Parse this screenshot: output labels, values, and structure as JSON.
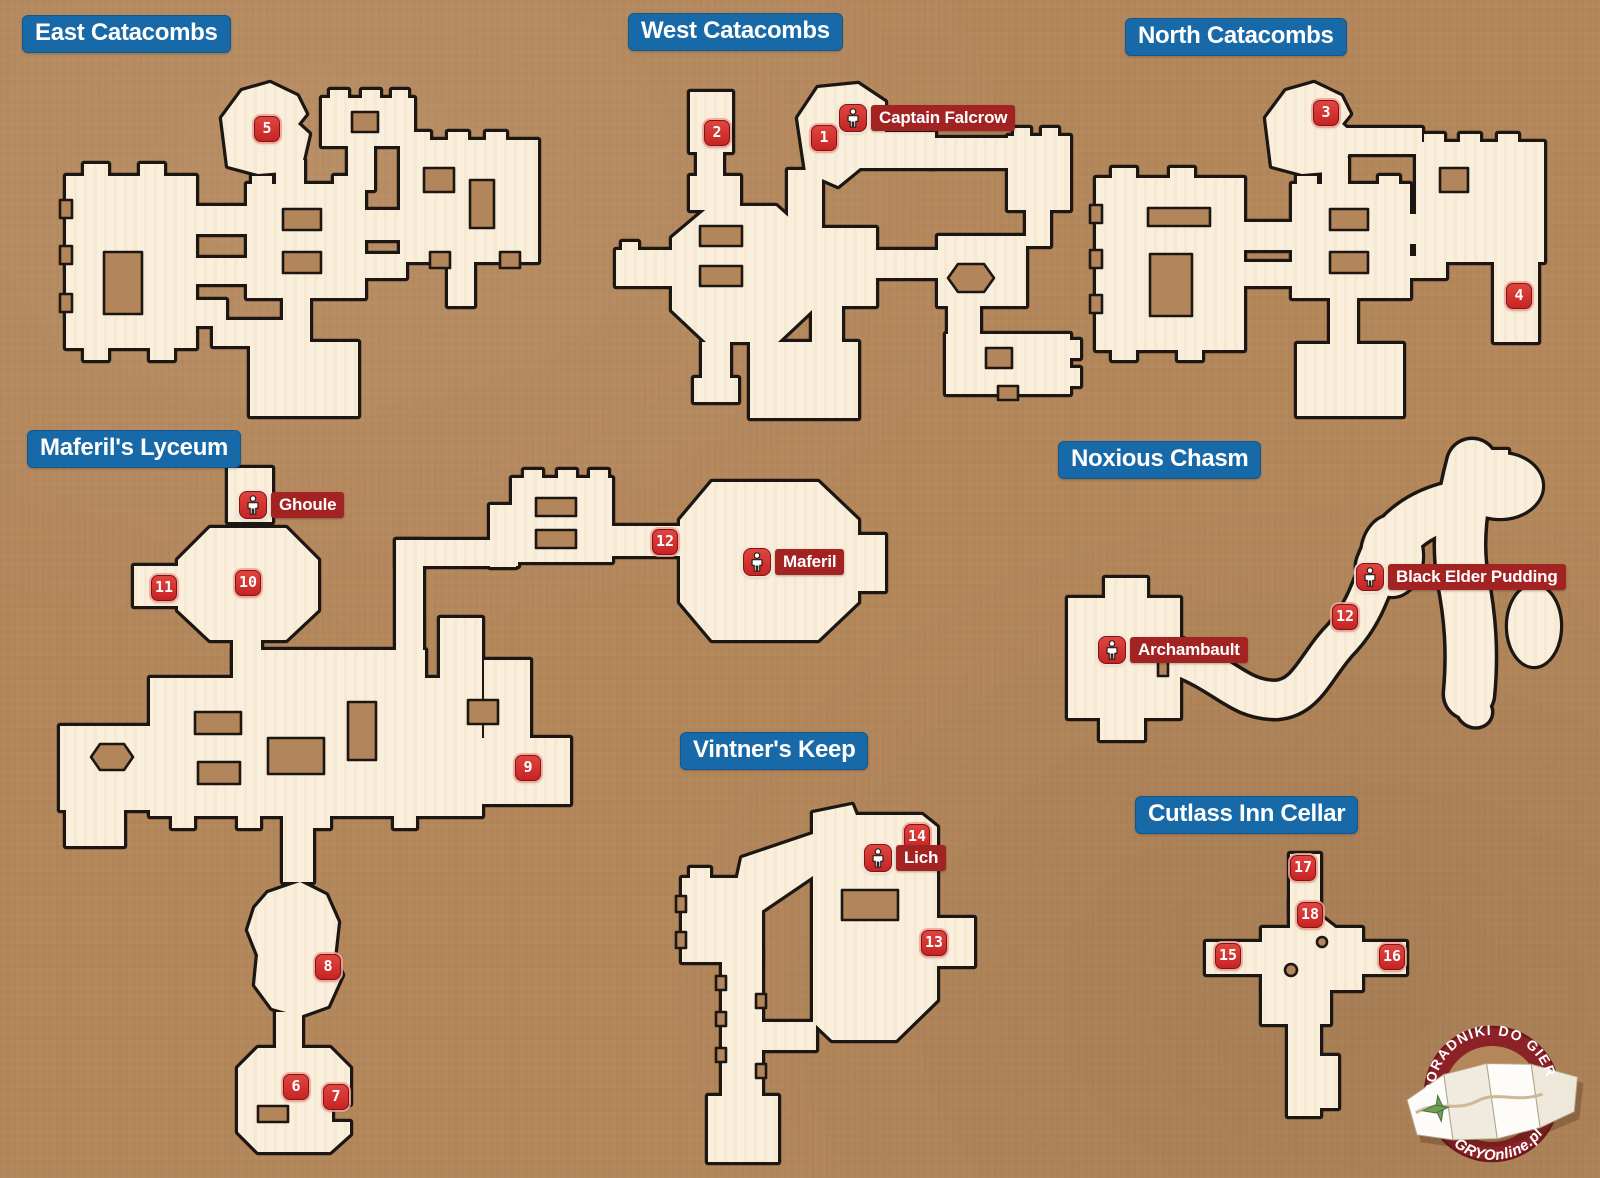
{
  "page": {
    "width": 1600,
    "height": 1178
  },
  "colors": {
    "background": "#b4875b",
    "map_fill": "#f9efdc",
    "outline": "#1d1713",
    "title_bg": "#1769a8",
    "marker_red": "#d03030",
    "npc_label_bg": "#a32323",
    "logo_red": "#8c2127"
  },
  "sections": [
    {
      "id": "east-catacombs",
      "title": "East Catacombs",
      "title_pos": {
        "x": 22,
        "y": 15
      }
    },
    {
      "id": "west-catacombs",
      "title": "West Catacombs",
      "title_pos": {
        "x": 628,
        "y": 13
      }
    },
    {
      "id": "north-catacombs",
      "title": "North Catacombs",
      "title_pos": {
        "x": 1125,
        "y": 18
      }
    },
    {
      "id": "maferils-lyceum",
      "title": "Maferil's Lyceum",
      "title_pos": {
        "x": 27,
        "y": 430
      }
    },
    {
      "id": "noxious-chasm",
      "title": "Noxious Chasm",
      "title_pos": {
        "x": 1058,
        "y": 441
      }
    },
    {
      "id": "vintners-keep",
      "title": "Vintner's Keep",
      "title_pos": {
        "x": 680,
        "y": 732
      }
    },
    {
      "id": "cutlass-inn-cellar",
      "title": "Cutlass Inn Cellar",
      "title_pos": {
        "x": 1135,
        "y": 796
      }
    }
  ],
  "markers": [
    {
      "section": "east-catacombs",
      "number": "5",
      "x": 267,
      "y": 129
    },
    {
      "section": "west-catacombs",
      "number": "2",
      "x": 717,
      "y": 133
    },
    {
      "section": "west-catacombs",
      "number": "1",
      "x": 824,
      "y": 138
    },
    {
      "section": "north-catacombs",
      "number": "3",
      "x": 1326,
      "y": 113
    },
    {
      "section": "north-catacombs",
      "number": "4",
      "x": 1519,
      "y": 296
    },
    {
      "section": "maferils-lyceum",
      "number": "11",
      "x": 164,
      "y": 588
    },
    {
      "section": "maferils-lyceum",
      "number": "10",
      "x": 248,
      "y": 583
    },
    {
      "section": "maferils-lyceum",
      "number": "12",
      "x": 665,
      "y": 542
    },
    {
      "section": "maferils-lyceum",
      "number": "9",
      "x": 528,
      "y": 768
    },
    {
      "section": "maferils-lyceum",
      "number": "8",
      "x": 328,
      "y": 967
    },
    {
      "section": "maferils-lyceum",
      "number": "6",
      "x": 296,
      "y": 1087
    },
    {
      "section": "maferils-lyceum",
      "number": "7",
      "x": 336,
      "y": 1097
    },
    {
      "section": "noxious-chasm",
      "number": "12",
      "x": 1345,
      "y": 617
    },
    {
      "section": "vintners-keep",
      "number": "14",
      "x": 917,
      "y": 837
    },
    {
      "section": "vintners-keep",
      "number": "13",
      "x": 934,
      "y": 943
    },
    {
      "section": "cutlass-inn-cellar",
      "number": "17",
      "x": 1303,
      "y": 868
    },
    {
      "section": "cutlass-inn-cellar",
      "number": "18",
      "x": 1310,
      "y": 915
    },
    {
      "section": "cutlass-inn-cellar",
      "number": "15",
      "x": 1228,
      "y": 956
    },
    {
      "section": "cutlass-inn-cellar",
      "number": "16",
      "x": 1392,
      "y": 957
    }
  ],
  "npcs": [
    {
      "section": "west-catacombs",
      "name": "Captain Falcrow",
      "x": 853,
      "y": 118
    },
    {
      "section": "maferils-lyceum",
      "name": "Ghoule",
      "x": 253,
      "y": 505
    },
    {
      "section": "maferils-lyceum",
      "name": "Maferil",
      "x": 757,
      "y": 562
    },
    {
      "section": "noxious-chasm",
      "name": "Black Elder Pudding",
      "x": 1370,
      "y": 577
    },
    {
      "section": "noxious-chasm",
      "name": "Archambault",
      "x": 1112,
      "y": 650
    },
    {
      "section": "vintners-keep",
      "name": "Lich",
      "x": 878,
      "y": 858
    }
  ],
  "logo": {
    "top_text": "PORADNIKI DO GIER",
    "bottom_text": "GRYOnline.pl"
  }
}
